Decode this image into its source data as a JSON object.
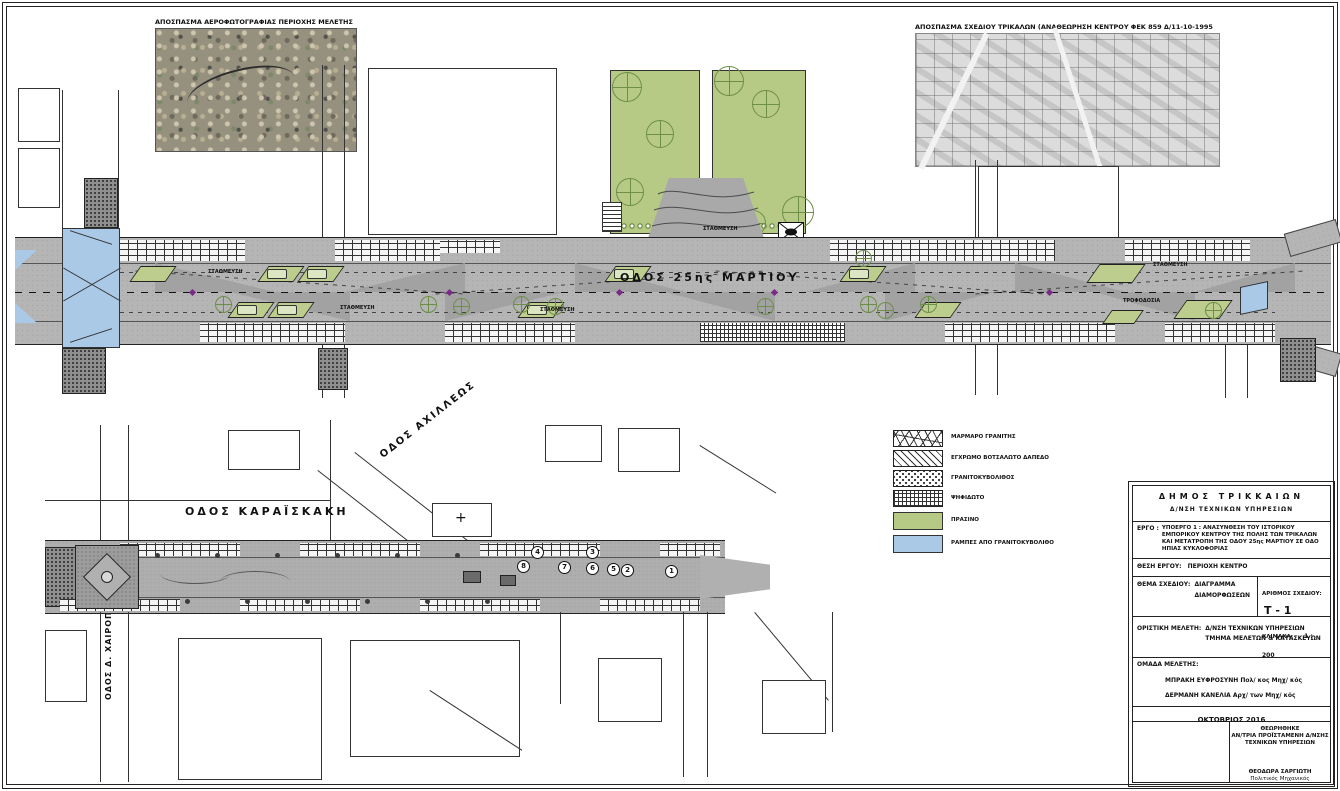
{
  "sheet": {
    "aerial_extract_label": "ΑΠΟΣΠΑΣΜΑ ΑΕΡΟΦΩΤΟΓΡΑΦΙΑΣ ΠΕΡΙΟΧΗΣ ΜΕΛΕΤΗΣ",
    "cityplan_extract_label": "ΑΠΟΣΠΑΣΜΑ ΣΧΕΔΙΟΥ ΤΡΙΚΑΛΩΝ (ΑΝΑΘΕΩΡΗΣΗ ΚΕΝΤΡΟΥ  ΦΕΚ 859 Δ/11-10-1995"
  },
  "upper_plan": {
    "street_label": "ΟΔΟΣ 25ης ΜΑΡΤΙΟΥ",
    "parking_label": "ΣΤΑΘΜΕΥΣΗ",
    "loading_label": "ΤΡΟΦΟΔΟΣΙΑ"
  },
  "lower_plan": {
    "street_karaiskaki": "ΟΔΟΣ ΚΑΡΑΪΣΚΑΚΗ",
    "street_achilleos": "ΟΔΟΣ ΑΧΙΛΛΕΩΣ",
    "street_chairopoulou": "ΟΔΟΣ Δ. ΧΑΙΡΟΠΟΥΛΟΥ",
    "markers": [
      "1",
      "2",
      "3",
      "4",
      "5",
      "6",
      "7",
      "8"
    ],
    "cross_symbol": "+"
  },
  "legend": {
    "items": [
      {
        "label": "ΜΑΡΜΑΡΟ ΓΡΑΝΙΤΗΣ"
      },
      {
        "label": "ΕΓΧΡΩΜΟ ΒΟΤΣΑΛΩΤΟ ΔΑΠΕΔΟ"
      },
      {
        "label": "ΓΡΑΝΙΤΟΚΥΒΟΛΙΘΟΣ"
      },
      {
        "label": "ΨΗΦΙΔΩΤΟ"
      },
      {
        "label": "ΠΡΑΣΙΝΟ"
      },
      {
        "label": "ΡΑΜΠΕΣ ΑΠΟ ΓΡΑΝΙΤΟΚΥΒΟΛΙΘΟ"
      }
    ],
    "green_hex": "#b6ca86",
    "blue_hex": "#a9c9e7"
  },
  "title_block": {
    "municipality": "ΔΗΜΟΣ ΤΡΙΚΚΑΙΩΝ",
    "department": "Δ/ΝΣΗ ΤΕΧΝΙΚΩΝ ΥΠΗΡΕΣΙΩΝ",
    "project_label": "ΕΡΓΟ :",
    "project_text": "ΥΠΟΕΡΓΟ 1 : ΑΝΑΣΥΝΘΕΣΗ ΤΟΥ ΙΣΤΟΡΙΚΟΥ ΕΜΠΟΡΙΚΟΥ ΚΕΝΤΡΟΥ ΤΗΣ ΠΟΛΗΣ ΤΩΝ ΤΡΙΚΑΛΩΝ ΚΑΙ ΜΕΤΑΤΡΟΠΗ ΤΗΣ ΟΔΟΥ 25ης ΜΑΡΤΙΟΥ ΣΕ ΟΔΟ ΗΠΙΑΣ ΚΥΚΛΟΦΟΡΙΑΣ",
    "location_label": "ΘΕΣΗ ΕΡΓΟΥ:",
    "location_text": "ΠΕΡΙΟΧΗ ΚΕΝΤΡΟ",
    "subject_label": "ΘΕΜΑ ΣΧΕΔΙΟΥ:",
    "subject_line1": "ΔΙΑΓΡΑΜΜΑ",
    "subject_line2": "ΔΙΑΜΟΡΦΩΣΕΩΝ",
    "number_label": "ΑΡΙΘΜΟΣ ΣΧΕΔΙΟΥ:",
    "number_value": "Τ - 1",
    "scale_label": "ΚΛΙΜΑΚΑ:",
    "scale_value": "1 : 200",
    "final_study_label": "ΟΡΙΣΤΙΚΗ ΜΕΛΕΤΗ:",
    "final_study_line1": "Δ/ΝΣΗ ΤΕΧΝΙΚΩΝ ΥΠΗΡΕΣΙΩΝ",
    "final_study_line2": "ΤΜΗΜΑ ΜΕΛΕΤΩΝ & ΚΑΤΑΣΚΕΥΩΝ",
    "team_label": "ΟΜΑΔΑ ΜΕΛΕΤΗΣ:",
    "team_member1": "ΜΠΡΑΚΗ ΕΥΦΡΟΣΥΝΗ Πολ/ κος Μηχ/ κός",
    "team_member2": "ΔΕΡΜΑΝΗ ΚΑΝΕΛΙΑ Αρχ/ των Μηχ/ κός",
    "date": "ΟΚΤΩΒΡΙΟΣ 2016",
    "approved_title": "ΘΕΩΡΗΘΗΚΕ",
    "approved_line1": "ΑΝ/ΤΡΙΑ ΠΡΟΪΣΤΑΜΕΝΗ Δ/ΝΣΗΣ",
    "approved_line2": "ΤΕΧΝΙΚΩΝ ΥΠΗΡΕΣΙΩΝ",
    "approved_name": "ΘΕΟΔΩΡΑ ΣΑΡΓΙΩΤΗ",
    "approved_role": "Πολιτικός Μηχανικός"
  }
}
